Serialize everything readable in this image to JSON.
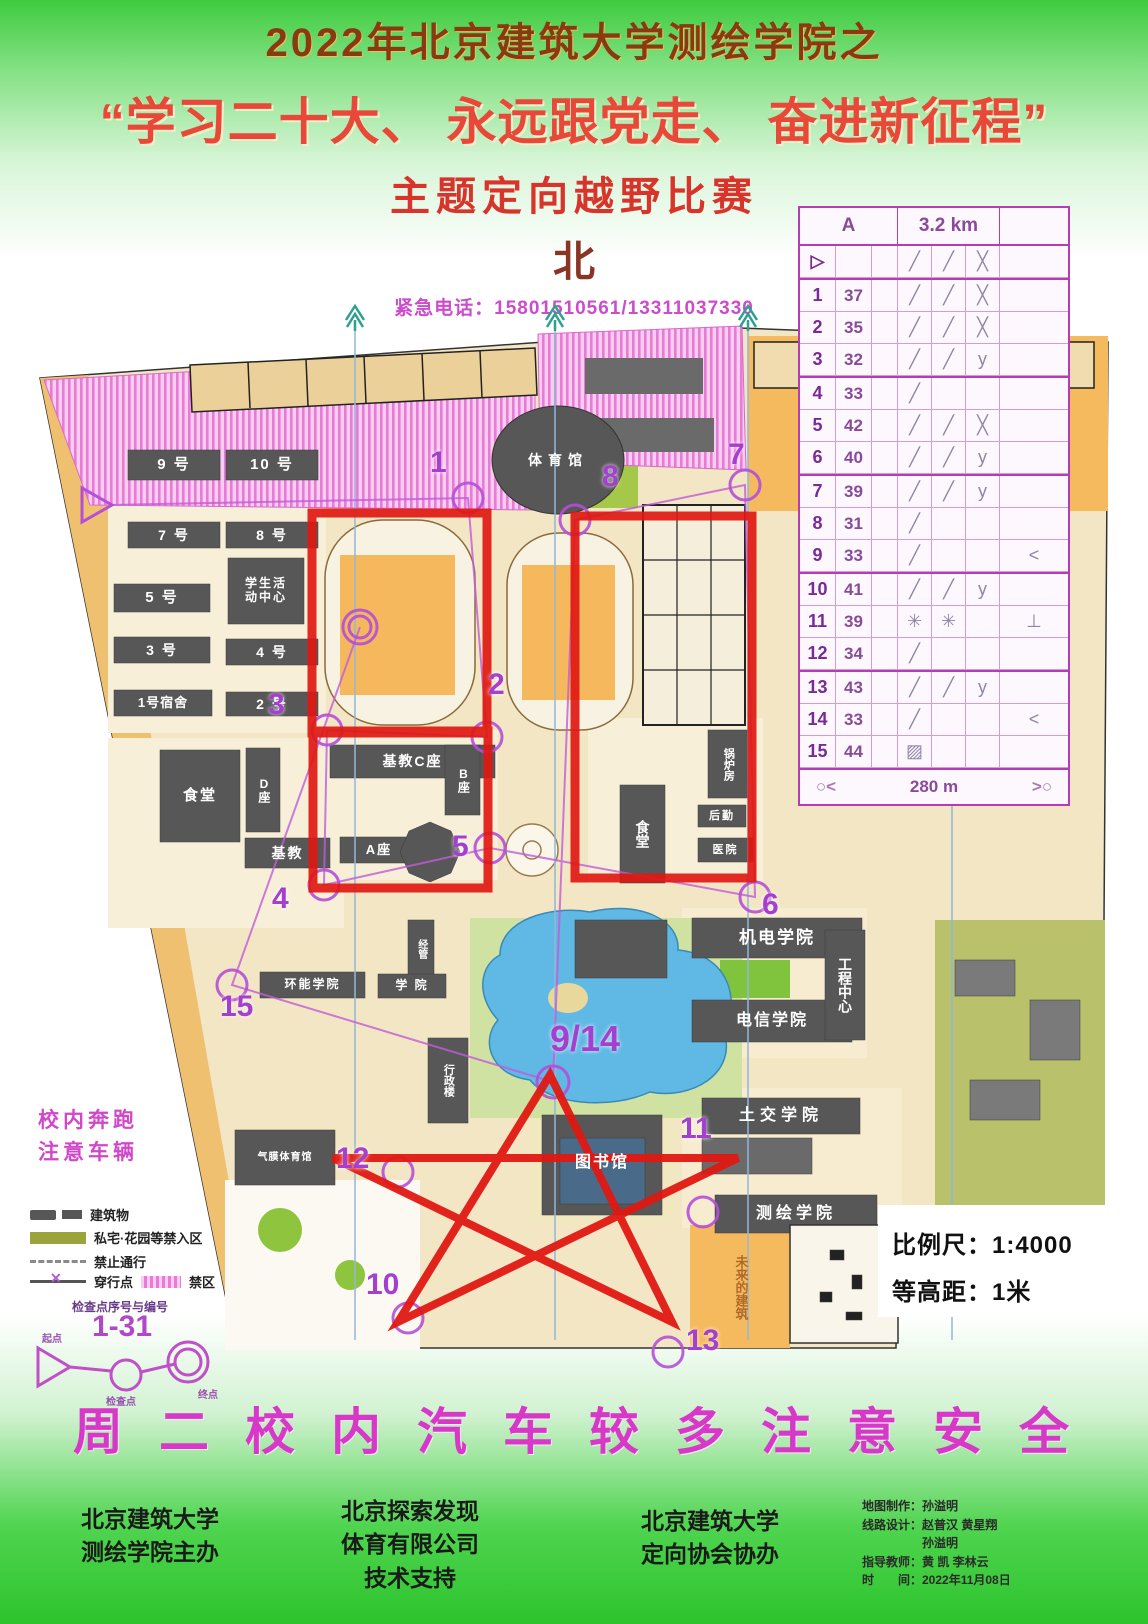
{
  "header": {
    "line1": "2022年北京建筑大学测绘学院之",
    "line2": "“学习二十大、 永远跟党走、 奋进新征程”",
    "line3": "主题定向越野比赛",
    "north": "北",
    "emergency": "紧急电话：15801510561/13311037330"
  },
  "control_card": {
    "course": "A",
    "distance": "3.2 km",
    "rows": [
      {
        "n": "▷",
        "c": "",
        "d": "╱",
        "e": "╱",
        "f": "╳",
        "g": ""
      },
      {
        "n": "1",
        "c": "37",
        "d": "╱",
        "e": "╱",
        "f": "╳",
        "g": ""
      },
      {
        "n": "2",
        "c": "35",
        "d": "╱",
        "e": "╱",
        "f": "╳",
        "g": ""
      },
      {
        "n": "3",
        "c": "32",
        "d": "╱",
        "e": "╱",
        "f": "y",
        "g": ""
      },
      {
        "n": "4",
        "c": "33",
        "d": "╱",
        "e": "",
        "f": "",
        "g": ""
      },
      {
        "n": "5",
        "c": "42",
        "d": "╱",
        "e": "╱",
        "f": "╳",
        "g": ""
      },
      {
        "n": "6",
        "c": "40",
        "d": "╱",
        "e": "╱",
        "f": "y",
        "g": ""
      },
      {
        "n": "7",
        "c": "39",
        "d": "╱",
        "e": "╱",
        "f": "y",
        "g": ""
      },
      {
        "n": "8",
        "c": "31",
        "d": "╱",
        "e": "",
        "f": "",
        "g": ""
      },
      {
        "n": "9",
        "c": "33",
        "d": "╱",
        "e": "",
        "f": "",
        "g": "<"
      },
      {
        "n": "10",
        "c": "41",
        "d": "╱",
        "e": "╱",
        "f": "y",
        "g": ""
      },
      {
        "n": "11",
        "c": "39",
        "d": "✳",
        "e": "✳",
        "f": "",
        "g": "⊥"
      },
      {
        "n": "12",
        "c": "34",
        "d": "╱",
        "e": "",
        "f": "",
        "g": ""
      },
      {
        "n": "13",
        "c": "43",
        "d": "╱",
        "e": "╱",
        "f": "y",
        "g": ""
      },
      {
        "n": "14",
        "c": "33",
        "d": "╱",
        "e": "",
        "f": "",
        "g": "<"
      },
      {
        "n": "15",
        "c": "44",
        "d": "▨",
        "e": "",
        "f": "",
        "g": ""
      }
    ],
    "finish_left": "○<",
    "finish_distance": "280 m",
    "finish_right": ">○"
  },
  "map": {
    "labels": {
      "dorm9": "9 号",
      "dorm10": "10 号",
      "dorm7": "7 号",
      "dorm8": "8 号",
      "center1": "学生活",
      "center2": "动中心",
      "dorm5": "5 号",
      "dorm3": "3 号",
      "dorm4": "4 号",
      "dorm1": "1号宿舍",
      "dorm2": "2 号",
      "canteen_left": "食堂",
      "block_d": "D座",
      "jijiao": "基教",
      "jijiao_c": "基教C座",
      "block_b": "B座",
      "block_a": "A座",
      "gym": "体育馆",
      "canteen_right": "食堂",
      "boiler": "锅炉房",
      "logistics": "后勤",
      "hospital": "医院",
      "jidian": "机电学院",
      "dianxin": "电信学院",
      "gongcheng": "工程中心",
      "tujiao": "土交学院",
      "cehui": "测绘学院",
      "library": "图书馆",
      "qimo": "气膜体育馆",
      "xingzheng": "行政楼",
      "huanneng": "环能学院",
      "xueyuan": "学 院",
      "jingguan": "经管",
      "future": "未来的建筑"
    },
    "controls": {
      "n1": "1",
      "n2": "2",
      "n3": "3",
      "n4": "4",
      "n5": "5",
      "n6": "6",
      "n7": "7",
      "n8": "8",
      "n9": "9/14",
      "n10": "10",
      "n11": "11",
      "n12": "12",
      "n13": "13",
      "n15": "15"
    }
  },
  "legend": {
    "warning1": "校内奔跑",
    "warning2": "注意车辆",
    "buildings": "建筑物",
    "private": "私宅·花园等禁入区",
    "no_entry": "禁止通行",
    "crossing": "穿行点",
    "forbidden": "禁区",
    "codes_title": "检查点序号与编号",
    "codes_range": "1-31",
    "start": "起点",
    "checkpoint": "检查点",
    "finish": "终点"
  },
  "scale": {
    "ratio": "比例尺：1:4000",
    "contour": "等高距：1米"
  },
  "footer": {
    "safety": "周二校内汽车较多注意安全",
    "org1a": "北京建筑大学",
    "org1b": "测绘学院主办",
    "org2a": "北京探索发现",
    "org2b": "体育有限公司",
    "org2c": "技术支持",
    "org3a": "北京建筑大学",
    "org3b": "定向协会协办",
    "credits": [
      "地图制作：孙溢明",
      "线路设计：赵普汉 黄星翔",
      "　　　　　孙溢明",
      "指导教师：黄 凯 李林云",
      "时　　间：2022年11月08日"
    ]
  }
}
